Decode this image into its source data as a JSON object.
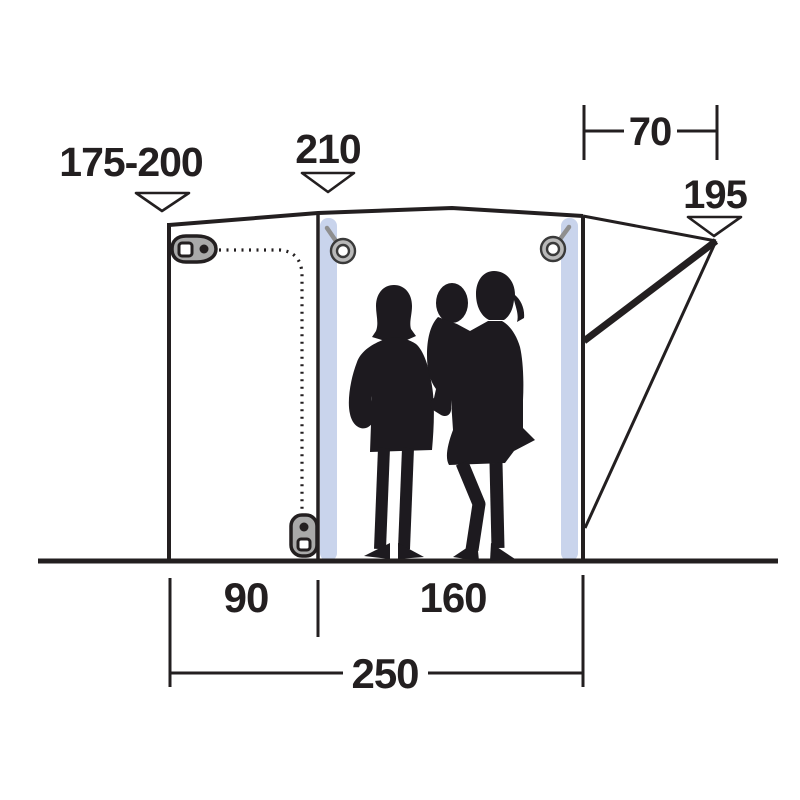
{
  "diagram": {
    "labels": {
      "front_height_range": "175-200",
      "mid_height": "210",
      "rear_overhang_depth": "70",
      "rear_height": "195",
      "front_panel_width": "90",
      "main_panel_width": "160",
      "total_width": "250"
    },
    "colors": {
      "line": "#231f20",
      "pole_fill": "#c9d4ec",
      "silhouette": "#1d1a1f",
      "zipper_fill": "#a9a9a9",
      "background": "#ffffff"
    }
  }
}
